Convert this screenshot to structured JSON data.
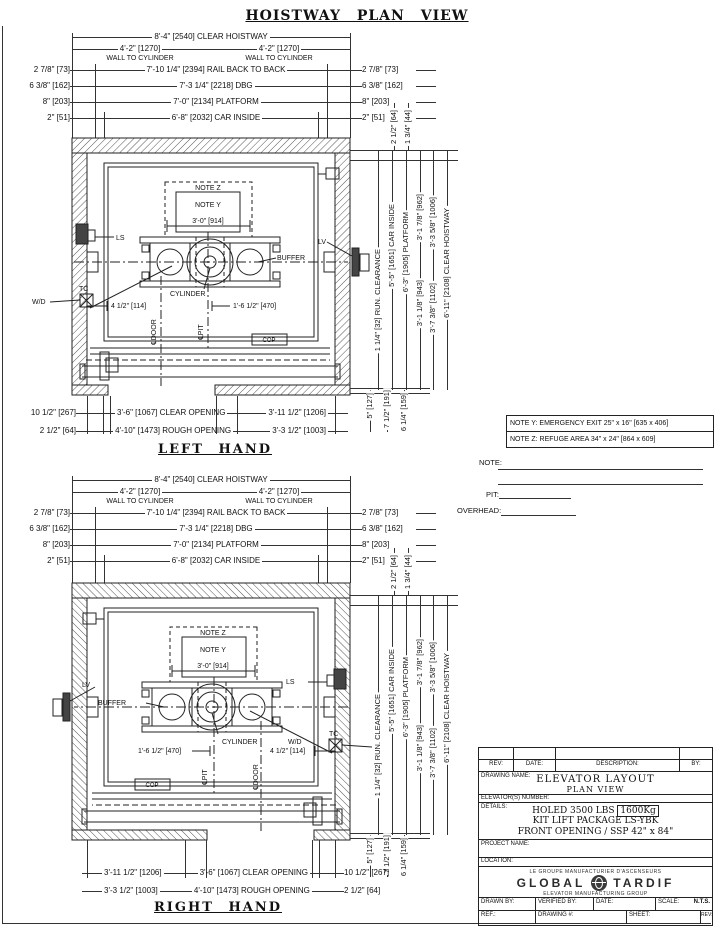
{
  "page": {
    "title": "HOISTWAY PLAN VIEW"
  },
  "drawings": {
    "left_title": "LEFT HAND",
    "right_title": "RIGHT HAND"
  },
  "top_dims": {
    "clear_hoistway": "8'-4\" [2540] CLEAR HOISTWAY",
    "wall_to_cyl": "4'-2\" [1270]",
    "wall_to_cyl_sub": "WALL TO CYLINDER",
    "rail_side": "2 7/8\" [73]",
    "rail_center": "7'-10 1/4\" [2394] RAIL BACK TO BACK",
    "dbg_side": "6 3/8\" [162]",
    "dbg_center": "7'-3 1/4\" [2218] DBG",
    "platform_side": "8\" [203]",
    "platform_center": "7'-0\" [2134] PLATFORM",
    "car_side": "2\" [51]",
    "car_center": "6'-8\" [2032] CAR INSIDE"
  },
  "plan": {
    "note_z": "NOTE Z",
    "note_y": "NOTE Y",
    "dim_3_0": "3'-0\" [914]",
    "ls": "LS",
    "lv": "LV",
    "tc": "TC",
    "wd": "W/D",
    "buffer": "BUFFER",
    "cylinder": "CYLINDER",
    "dim_4_half": "4 1/2\" [114]",
    "dim_1_6": "1'-6 1/2\" [470]",
    "cl_door": "℄DOOR",
    "cl_pit": "℄PIT",
    "cop": "COP"
  },
  "right_dims": {
    "d_64": "2 1/2\" [64]",
    "d_44": "1 3/4\" [44]",
    "run_clearance": "1 1/4\" [32] RUN. CLEARANCE",
    "car_inside": "5'-5\" [1651] CAR INSIDE",
    "platform": "6'-3\" [1905] PLATFORM",
    "d_962": "3'-1 7/8\" [962]",
    "d_1006": "3'-3 5/8\" [1006]",
    "d_943": "3'-1 1/8\" [943]",
    "d_1102": "3'-7 3/8\" [1102]",
    "clear_hoistway": "6'-11\" [2108] CLEAR HOISTWAY",
    "d_127": "5\" [127]",
    "d_191": "7 1/2\" [191]",
    "d_159": "6 1/4\" [159]"
  },
  "bottom_dims": {
    "d_267": "10 1/2\" [267]",
    "clear_opening": "3'-6\" [1067] CLEAR OPENING",
    "d_1206": "3'-11 1/2\" [1206]",
    "d_64": "2 1/2\" [64]",
    "rough_opening": "4'-10\" [1473] ROUGH OPENING",
    "d_1003": "3'-3 1/2\" [1003]"
  },
  "notes_box": {
    "note_y": "NOTE Y: EMERGENCY EXIT 25\" x 16\" [635 x 406]",
    "note_z": "NOTE Z: REFUGE AREA 34\" x 24\" [864 x 609]"
  },
  "fields": {
    "note": "NOTE:",
    "pit": "PIT:",
    "overhead": "OVERHEAD:"
  },
  "title_block": {
    "rev": "REV:",
    "date": "DATE:",
    "description": "DESCRIPTION:",
    "by": "BY:",
    "drawing_name_label": "DRAWING NAME:",
    "drawing_name_line1": "ELEVATOR LAYOUT",
    "drawing_name_line2": "PLAN VIEW",
    "elevator_number_label": "ELEVATOR(S) NUMBER:",
    "details_label": "DETAILS:",
    "details_line1_text": "HOLED 3500 LBS",
    "details_line1_boxed": "1600Kg",
    "details_line2": "KIT LIFT PACKAGE LS-YBK",
    "details_line3": "FRONT OPENING / SSP 42\" x 84\"",
    "project_name_label": "PROJECT NAME:",
    "location_label": "LOCATION:",
    "logo_tagline_top": "LE GROUPE MANUFACTURIER D'ASCENSEURS",
    "logo_word_left": "GLOBAL",
    "logo_word_right": "TARDIF",
    "logo_tagline_bottom": "ELEVATOR MANUFACTURING GROUP",
    "drawn_by": "DRAWN BY:",
    "verified_by": "VERIFIED BY:",
    "date_label": "DATE:",
    "scale_label": "SCALE:",
    "scale_value": "N.T.S.",
    "ref_label": "REF.:",
    "drawing_number_label": "DRAWING #:",
    "sheet_label": "SHEET:",
    "rev_label": "REV:"
  }
}
